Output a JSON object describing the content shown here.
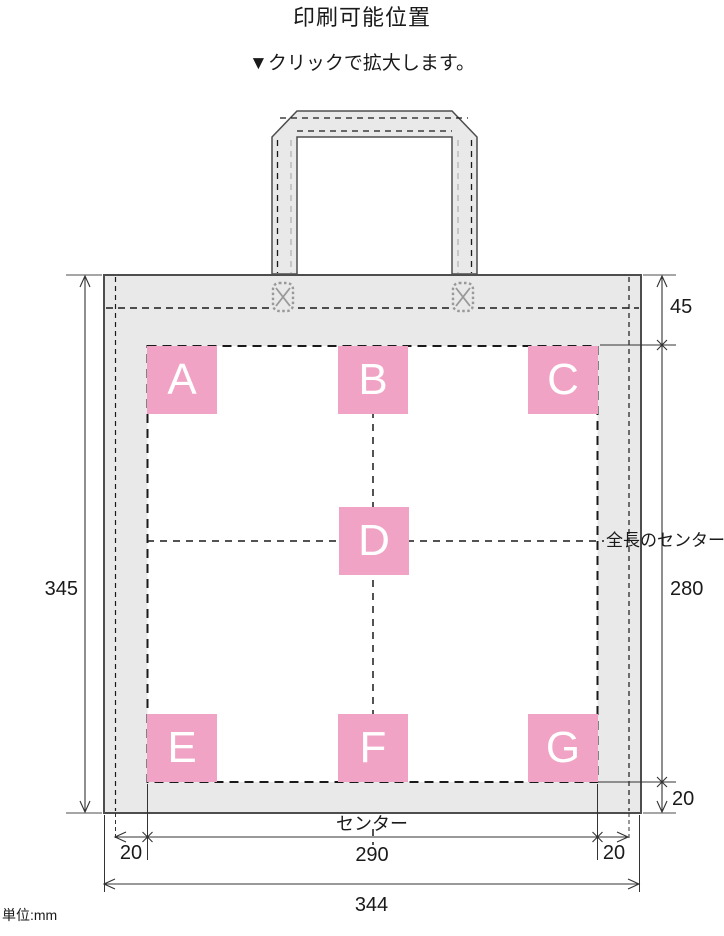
{
  "title": "印刷可能位置",
  "subtitle": {
    "icon": "▼",
    "text": "クリックで拡大します。"
  },
  "unit_note": "単位:mm",
  "boxes": [
    "A",
    "B",
    "C",
    "D",
    "E",
    "F",
    "G"
  ],
  "dims": {
    "bag_height": "345",
    "top_seam": "45",
    "print_height": "280",
    "bottom_seam": "20",
    "side_left": "20",
    "print_width": "290",
    "side_right": "20",
    "bag_width": "344",
    "center": "センター",
    "full_length_center": "全長のセンター"
  },
  "colors": {
    "pink": "#F1A3C5",
    "bag_gray": "#E9E9E9",
    "outline": "#4D4D4D",
    "dash": "#1A1A1A",
    "stitch_gray": "#999999"
  }
}
